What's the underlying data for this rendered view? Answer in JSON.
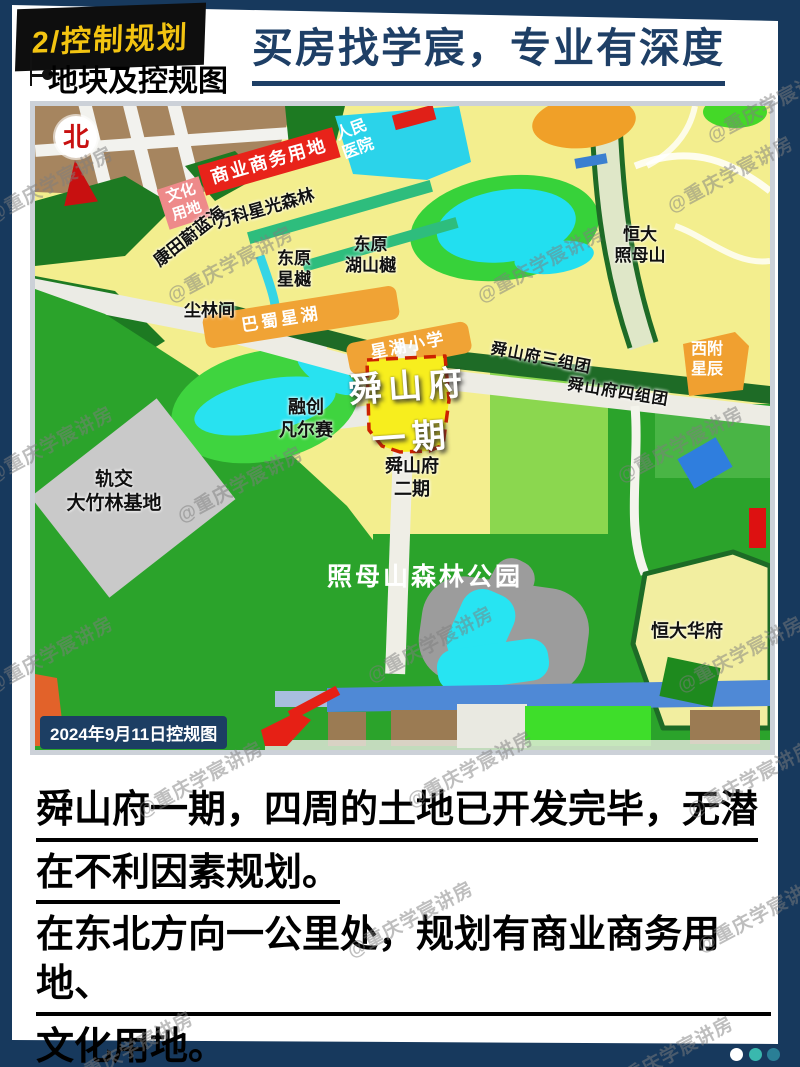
{
  "page": {
    "header": {
      "tag": "2/控制规划",
      "slogan": "买房找学宸，专业有深度",
      "section_title": "地块及控规图"
    },
    "watermark": {
      "text": "@重庆学宸讲房"
    },
    "colors": {
      "background_navy": "#17395d",
      "tag_background": "#0e0e0e",
      "tag_text": "#f3c411",
      "slogan_text": "#1e3f66",
      "highlight_dash": "#cc2200",
      "highlight_fill": "#f7ee1e",
      "badge_background": "#1c3e63"
    },
    "footer": {
      "dots": [
        "white",
        "teal",
        "dark-teal"
      ]
    }
  },
  "map": {
    "compass": "北",
    "caption": "2024年9月11日控规图",
    "labels": [
      {
        "text": "商业商务用地"
      },
      {
        "text": "文化\n用地"
      },
      {
        "text": "人民\n医院"
      },
      {
        "text": "万科星光森林"
      },
      {
        "text": "康田蔚蓝海"
      },
      {
        "text": "东原\n星樾"
      },
      {
        "text": "东原\n湖山樾"
      },
      {
        "text": "恒大\n照母山"
      },
      {
        "text": "尘林间"
      },
      {
        "text": "巴蜀星湖"
      },
      {
        "text": "星湖小学"
      },
      {
        "text": "舜山府三组团"
      },
      {
        "text": "舜山府四组团"
      },
      {
        "text": "西附\n星辰"
      },
      {
        "text": "舜山府\n一期"
      },
      {
        "text": "融创\n凡尔赛"
      },
      {
        "text": "舜山府\n二期"
      },
      {
        "text": "轨交\n大竹林基地"
      },
      {
        "text": "照母山森林公园"
      },
      {
        "text": "恒大华府"
      }
    ]
  },
  "notes": {
    "lines": [
      "舜山府一期，四周的土地已开发完毕，无潜",
      "在不利因素规划。",
      "在东北方向一公里处，规划有商业商务用地、",
      "文化用地。"
    ]
  }
}
